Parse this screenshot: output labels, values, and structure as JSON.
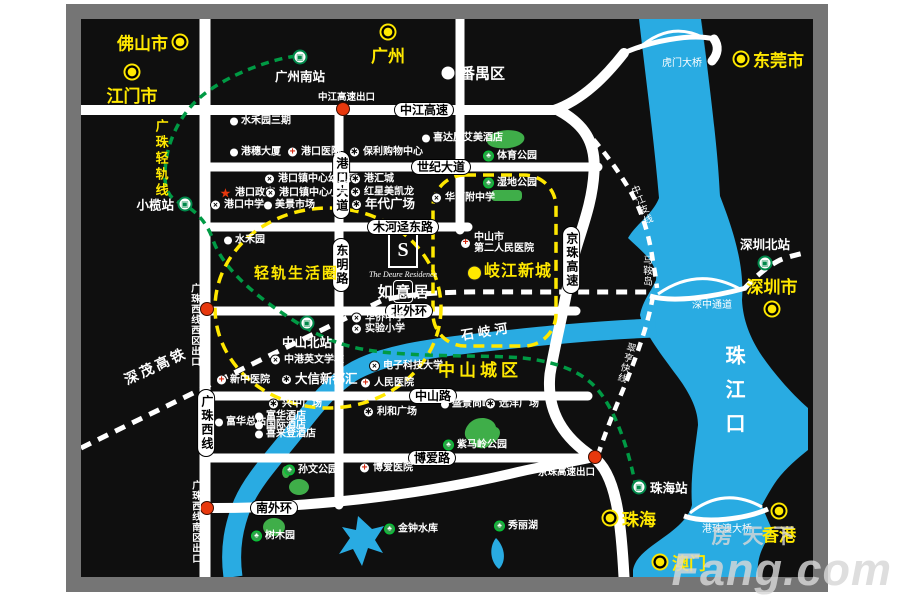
{
  "colors": {
    "accent_yellow": "#ffe800",
    "water": "#29abe2",
    "park": "#3fae49",
    "rail_green": "#009a44",
    "exit_red": "#e8380d",
    "frame_gray": "#757575"
  },
  "icons": {
    "school": "×",
    "mall": "∗",
    "hospital": "+",
    "park": "♣",
    "star": "★",
    "train": "▣"
  },
  "logo": {
    "monogram": "S",
    "en": "The Deure Residence",
    "cn": [
      "如",
      "意",
      "居"
    ]
  },
  "watermark": {
    "cn": "房天下",
    "en": "Fang.com"
  },
  "cities": [
    {
      "label": "佛山市",
      "x": 180,
      "y": 42,
      "side": "l",
      "kind": "yellow"
    },
    {
      "label": "江门市",
      "x": 132,
      "y": 72,
      "side": "b",
      "kind": "yellow"
    },
    {
      "label": "广州",
      "x": 388,
      "y": 32,
      "side": "b",
      "kind": "yellow"
    },
    {
      "label": "东莞市",
      "x": 741,
      "y": 59,
      "side": "r",
      "kind": "yellow"
    },
    {
      "label": "番禺区",
      "x": 448,
      "y": 73,
      "side": "r",
      "kind": "white"
    },
    {
      "label": "深圳市",
      "x": 772,
      "y": 309,
      "side": "a",
      "kind": "yellow"
    },
    {
      "label": "珠海",
      "x": 610,
      "y": 518,
      "side": "r",
      "kind": "yellow"
    },
    {
      "label": "香港",
      "x": 779,
      "y": 511,
      "side": "b",
      "kind": "yellow"
    },
    {
      "label": "澳门",
      "x": 660,
      "y": 562,
      "side": "r",
      "kind": "yellow"
    }
  ],
  "stations": [
    {
      "label": "广州南站",
      "x": 300,
      "y": 57,
      "side": "b"
    },
    {
      "label": "小榄站",
      "x": 185,
      "y": 204,
      "side": "l"
    },
    {
      "label": "中山北站",
      "x": 307,
      "y": 323,
      "side": "b"
    },
    {
      "label": "深圳北站",
      "x": 765,
      "y": 263,
      "side": "a"
    },
    {
      "label": "珠海站",
      "x": 639,
      "y": 487,
      "side": "r"
    }
  ],
  "road_pills": [
    {
      "label": "中江高速",
      "x": 424,
      "y": 110,
      "vert": false
    },
    {
      "label": "世纪大道",
      "x": 441,
      "y": 167,
      "vert": false
    },
    {
      "label": "木河迳东路",
      "x": 403,
      "y": 227,
      "vert": false
    },
    {
      "label": "北外环",
      "x": 409,
      "y": 311,
      "vert": false
    },
    {
      "label": "中山路",
      "x": 433,
      "y": 396,
      "vert": false
    },
    {
      "label": "博爱路",
      "x": 432,
      "y": 458,
      "vert": false
    },
    {
      "label": "南外环",
      "x": 274,
      "y": 508,
      "vert": false
    },
    {
      "label": "港口大道",
      "x": 341,
      "y": 185,
      "vert": true
    },
    {
      "label": "东明路",
      "x": 341,
      "y": 265,
      "vert": true
    },
    {
      "label": "广珠西线",
      "x": 206,
      "y": 423,
      "vert": true
    },
    {
      "label": "京珠高速",
      "x": 571,
      "y": 260,
      "vert": true
    }
  ],
  "exits": [
    {
      "label": "中江高速出口",
      "lx": 318,
      "ly": 89,
      "vert": false,
      "dx": 343,
      "dy": 109
    },
    {
      "label": "广珠西线西区出口",
      "lx": 187,
      "ly": 283,
      "vert": true,
      "dx": 207,
      "dy": 309
    },
    {
      "label": "广珠西线南区出口",
      "lx": 188,
      "ly": 480,
      "vert": true,
      "dx": 207,
      "dy": 508
    },
    {
      "label": "京珠高速出口",
      "lx": 538,
      "ly": 464,
      "vert": false,
      "dx": 595,
      "dy": 457
    }
  ],
  "pois": [
    {
      "t": "dot",
      "label": "水禾园三期",
      "x": 236,
      "y": 121
    },
    {
      "t": "dot",
      "label": "港穗大厦",
      "x": 236,
      "y": 152
    },
    {
      "t": "hosp",
      "label": "港口医院",
      "x": 293,
      "y": 152
    },
    {
      "t": "mall",
      "label": "保利购物中心",
      "x": 355,
      "y": 152
    },
    {
      "t": "school",
      "label": "港口镇中心幼儿园",
      "x": 270,
      "y": 179
    },
    {
      "t": "star",
      "label": "港口政府",
      "x": 225,
      "y": 193
    },
    {
      "t": "school",
      "label": "港口镇中心小学",
      "x": 271,
      "y": 193
    },
    {
      "t": "school",
      "label": "港口中学",
      "x": 216,
      "y": 205
    },
    {
      "t": "dot",
      "label": "美景市场",
      "x": 270,
      "y": 205
    },
    {
      "t": "mall",
      "label": "港汇城",
      "x": 356,
      "y": 179
    },
    {
      "t": "mall",
      "label": "红星美凯龙",
      "x": 356,
      "y": 192
    },
    {
      "t": "mall",
      "label": "年代广场",
      "x": 357,
      "y": 205,
      "big": true
    },
    {
      "t": "dot",
      "label": "水禾园",
      "x": 230,
      "y": 240
    },
    {
      "t": "dot",
      "label": "喜达屋艾美酒店",
      "x": 428,
      "y": 138
    },
    {
      "t": "park",
      "label": "体育公园",
      "x": 489,
      "y": 156
    },
    {
      "t": "park",
      "label": "湿地公园",
      "x": 489,
      "y": 183
    },
    {
      "t": "school",
      "label": "华师附中学",
      "x": 437,
      "y": 198
    },
    {
      "t": "hosp",
      "label": "中山市\n第二人民医院",
      "x": 466,
      "y": 243
    },
    {
      "t": "ydot",
      "label": "",
      "x": 473,
      "y": 273
    },
    {
      "t": "school",
      "label": "华侨中学",
      "x": 357,
      "y": 318
    },
    {
      "t": "school",
      "label": "实验小学",
      "x": 357,
      "y": 329
    },
    {
      "t": "school",
      "label": "电子科技大学",
      "x": 375,
      "y": 366
    },
    {
      "t": "hosp",
      "label": "人民医院",
      "x": 366,
      "y": 383
    },
    {
      "t": "hosp",
      "label": "新中医院",
      "x": 222,
      "y": 380
    },
    {
      "t": "mall",
      "label": "大信新都汇",
      "x": 287,
      "y": 380,
      "big": true
    },
    {
      "t": "school",
      "label": "中港英文学校",
      "x": 276,
      "y": 360
    },
    {
      "t": "mall",
      "label": "兴中广场",
      "x": 274,
      "y": 404
    },
    {
      "t": "dot",
      "label": "富华总站",
      "x": 221,
      "y": 422
    },
    {
      "t": "dot",
      "label": "富华酒店",
      "x": 261,
      "y": 416
    },
    {
      "t": "dot",
      "label": "国际酒店",
      "x": 261,
      "y": 425
    },
    {
      "t": "dot",
      "label": "喜来登酒店",
      "x": 261,
      "y": 434
    },
    {
      "t": "dot",
      "label": "盛景尚峰",
      "x": 447,
      "y": 404
    },
    {
      "t": "mall",
      "label": "远洋广场",
      "x": 491,
      "y": 404
    },
    {
      "t": "mall",
      "label": "利和广场",
      "x": 369,
      "y": 412
    },
    {
      "t": "park",
      "label": "紫马岭公园",
      "x": 449,
      "y": 445
    },
    {
      "t": "hosp",
      "label": "博爱医院",
      "x": 365,
      "y": 468
    },
    {
      "t": "park",
      "label": "孙文公园",
      "x": 290,
      "y": 470
    },
    {
      "t": "park",
      "label": "金钟水库",
      "x": 390,
      "y": 529
    },
    {
      "t": "park",
      "label": "秀丽湖",
      "x": 500,
      "y": 526
    },
    {
      "t": "park",
      "label": "树木园",
      "x": 257,
      "y": 536
    }
  ],
  "free_labels": [
    {
      "text": "轻轨生活圈",
      "x": 254,
      "y": 266,
      "size": 15,
      "color": "#ffe800",
      "bold": true,
      "ls": 2
    },
    {
      "text": "岐江新城",
      "x": 484,
      "y": 264,
      "size": 16,
      "color": "#ffe800",
      "bold": true,
      "ls": 1
    },
    {
      "text": "中山城区",
      "x": 438,
      "y": 362,
      "size": 17,
      "color": "#ffe800",
      "bold": true,
      "ls": 4
    },
    {
      "text": "珠江口",
      "x": 722,
      "y": 345,
      "size": 20,
      "color": "#fff",
      "bold": true,
      "vert": true,
      "ls": 14
    },
    {
      "text": "马鞍岛",
      "x": 641,
      "y": 255,
      "size": 9.5,
      "color": "#fff",
      "vert": true,
      "ls": 1
    },
    {
      "text": "广珠轻轨线",
      "x": 154,
      "y": 119,
      "size": 13,
      "color": "#ffe800",
      "bold": true,
      "vert": true,
      "ls": 3
    },
    {
      "text": "深茂高铁",
      "x": 122,
      "y": 374,
      "size": 14,
      "color": "#fff",
      "bold": true,
      "rot": -25,
      "ls": 3
    },
    {
      "text": "石岐河",
      "x": 460,
      "y": 329,
      "size": 13,
      "color": "#fff",
      "bold": true,
      "rot": -9,
      "ls": 4
    },
    {
      "text": "中江支线",
      "x": 628,
      "y": 188,
      "size": 9.5,
      "color": "#fff",
      "vert": true,
      "rot": -22,
      "ls": 1
    },
    {
      "text": "翠亨快线",
      "x": 626,
      "y": 341,
      "size": 9.5,
      "color": "#fff",
      "vert": true,
      "rot": 16,
      "ls": 1
    },
    {
      "text": "虎门大桥",
      "x": 662,
      "y": 59,
      "size": 10,
      "color": "#fff"
    },
    {
      "text": "深中通道",
      "x": 692,
      "y": 301,
      "size": 10,
      "color": "#fff"
    },
    {
      "text": "港珠澳大桥",
      "x": 702,
      "y": 525,
      "size": 10,
      "color": "#fff"
    }
  ]
}
